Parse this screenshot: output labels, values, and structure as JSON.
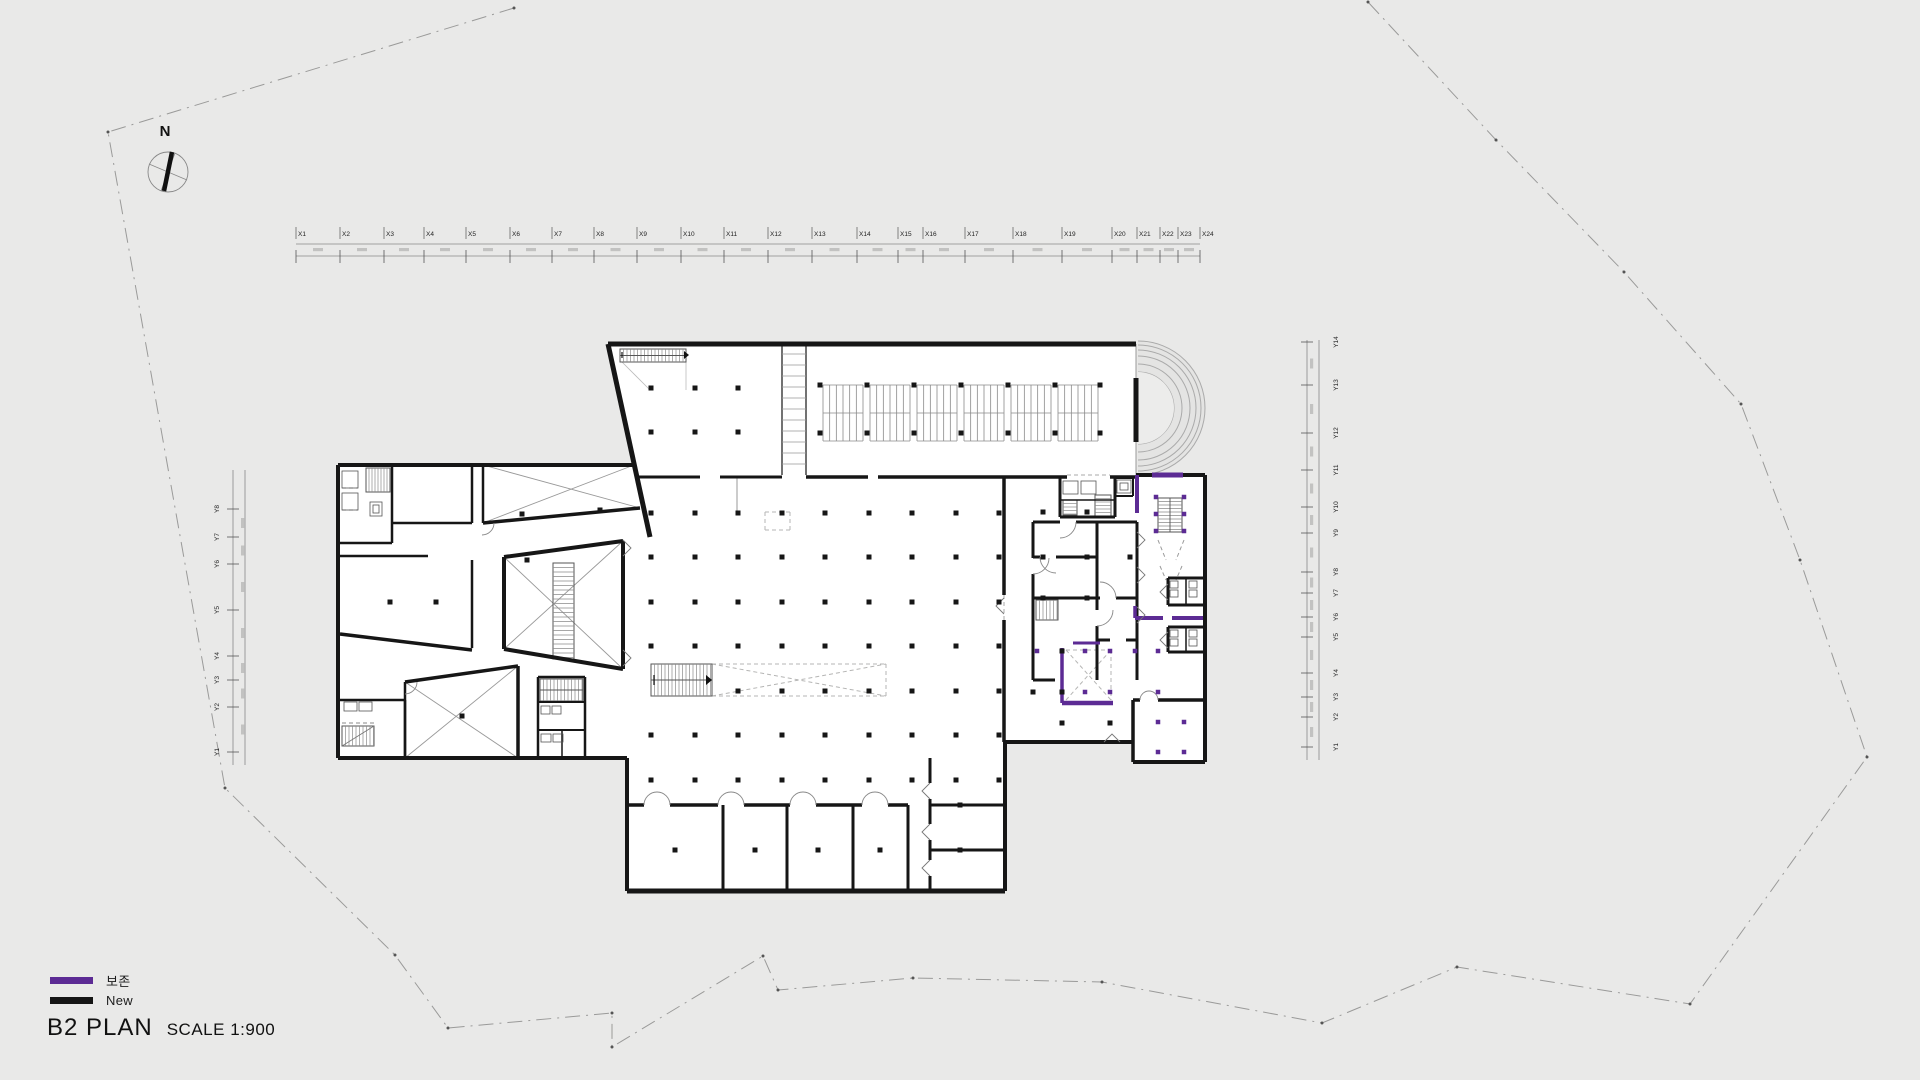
{
  "page": {
    "background": "#e9e9e8"
  },
  "title": {
    "main": "B2 PLAN",
    "scale": "SCALE 1:900"
  },
  "legend": {
    "items": [
      {
        "name": "preserved",
        "label": "보존",
        "color": "#5c2b94"
      },
      {
        "name": "new",
        "label": "New",
        "color": "#151515"
      }
    ]
  },
  "compass": {
    "label": "N"
  },
  "rulers": {
    "top_labels": [
      "X1",
      "X2",
      "X3",
      "X4",
      "X5",
      "X6",
      "X7",
      "X8",
      "X9",
      "X10",
      "X11",
      "X12",
      "X13",
      "X14",
      "X15",
      "X16",
      "X17",
      "X18",
      "X19",
      "X20",
      "X21",
      "X22",
      "X23",
      "X24"
    ],
    "left_labels": [
      "Y1",
      "Y2",
      "Y3",
      "Y4",
      "Y5",
      "Y6",
      "Y7",
      "Y8"
    ],
    "right_labels": [
      "Y1",
      "Y2",
      "Y3",
      "Y4",
      "Y5",
      "Y6",
      "Y7",
      "Y8",
      "Y9",
      "Y10",
      "Y11",
      "Y12",
      "Y13",
      "Y14"
    ]
  },
  "drawing": {
    "wall_color": "#161616",
    "preserved_color": "#5c2b94",
    "thin_line_color": "#999999",
    "boundary_color": "#9a9a99",
    "floor_color": "#ffffff"
  }
}
